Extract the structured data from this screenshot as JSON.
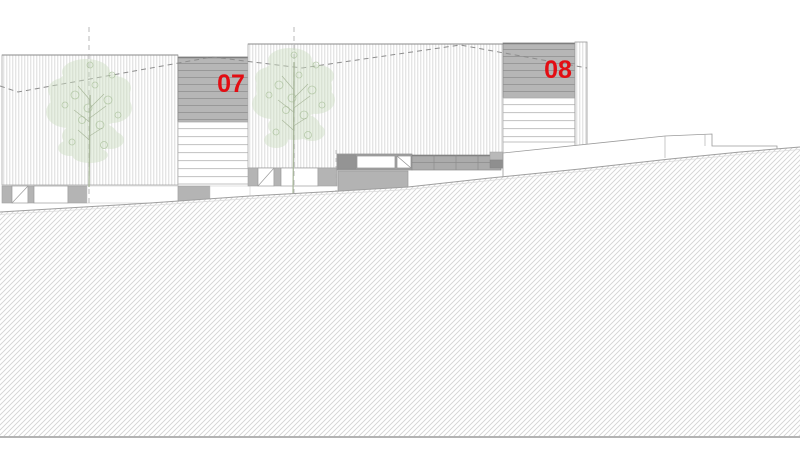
{
  "elevation": {
    "drawing_type": "architectural street elevation",
    "unit_labels": [
      {
        "id": "unit-07",
        "label": "07"
      },
      {
        "id": "unit-08",
        "label": "08"
      }
    ],
    "colors": {
      "unit_label_red": "#e30d13",
      "facade_hatch_line": "#d7d7d7",
      "louver_grey": "#b6b6b6",
      "louver_line": "#989898",
      "dark_band_grey": "#a2a2a2",
      "plinth_grey": "#b4b4b4",
      "ground_hatch_line": "#cecece",
      "outline_grey": "#9a9a9a",
      "dashed_line_grey": "#8d8d8d",
      "foliage_green": "#ccddc0",
      "foliage_stroke_green": "#9cb78b"
    }
  }
}
